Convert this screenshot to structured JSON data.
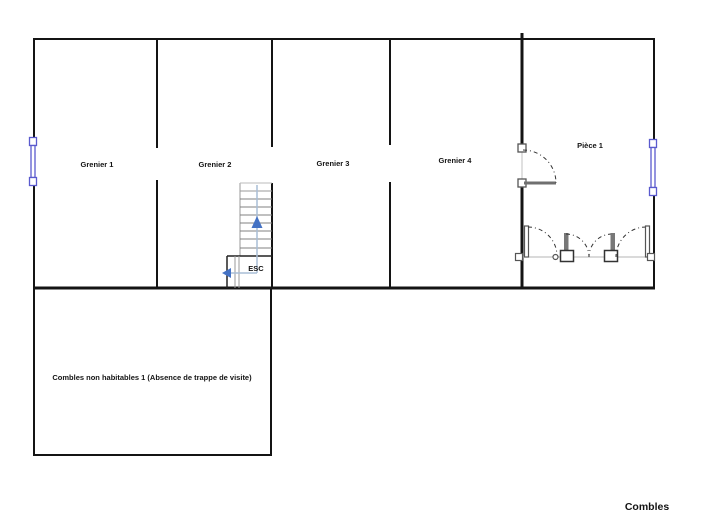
{
  "plan": {
    "floor_title": "Combles",
    "rooms": [
      {
        "label": "Grenier 1"
      },
      {
        "label": "Grenier 2"
      },
      {
        "label": "Grenier 3"
      },
      {
        "label": "Grenier 4"
      },
      {
        "label": "Pièce 1"
      },
      {
        "label": "Combles non habitables 1 (Absence de trappe de visite)"
      }
    ],
    "stair_label": "ESC"
  },
  "colors": {
    "wall": "#141414",
    "window": "#5a5ace",
    "arrow": "#4472c4",
    "stair_path": "#a9bdd6",
    "door_leaf": "#6f6f6f"
  },
  "symbols": {
    "window": "window-icon (double line with end squares)",
    "door_swing": "door-swing-icon (dashed quarter arc)",
    "stair_direction_up": "▲",
    "stair_exit_direction": "◀"
  }
}
